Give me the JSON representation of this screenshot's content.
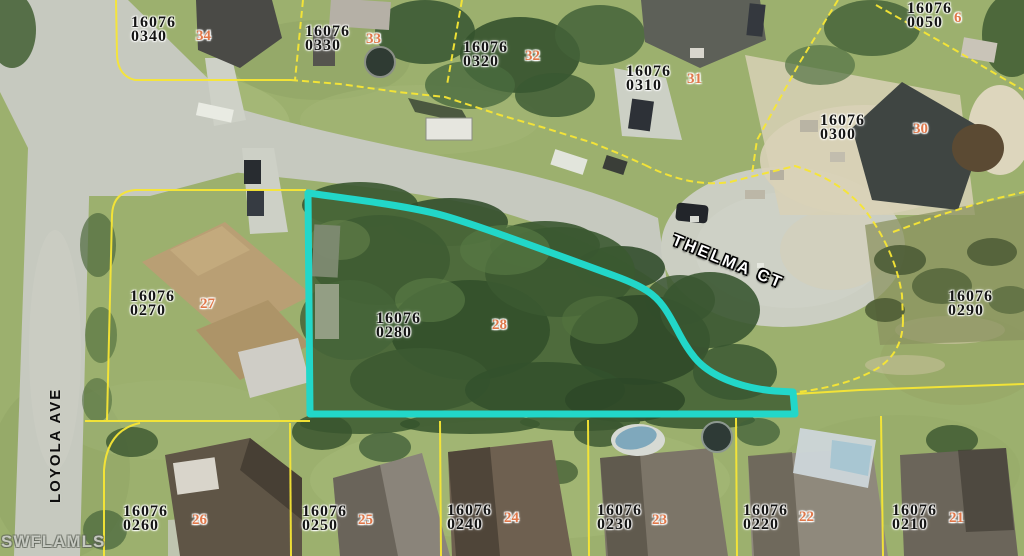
{
  "map": {
    "type": "aerial-parcel-map",
    "watermark": "SWFLAMLS",
    "streets": [
      {
        "name": "THELMA CT"
      },
      {
        "name": "LOYOLA AVE"
      }
    ],
    "colors": {
      "subject_outline": "#22d7c9",
      "parcel_line": "#f7e635",
      "parcel_text": "#141414",
      "lot_number_text": "#e0784a",
      "street_text_light": "#ffffff",
      "street_text_dark": "#0d0d0d"
    },
    "subject_parcel": {
      "id": "16076",
      "suffix": "0280",
      "lot": "28"
    },
    "parcels": [
      {
        "id": "16076",
        "suffix": "0340",
        "lot": "34",
        "x": 131,
        "y": 16,
        "lotX": 196,
        "lotY": 29
      },
      {
        "id": "16076",
        "suffix": "0330",
        "lot": "33",
        "x": 305,
        "y": 25,
        "lotX": 366,
        "lotY": 32
      },
      {
        "id": "16076",
        "suffix": "0320",
        "lot": "32",
        "x": 463,
        "y": 41,
        "lotX": 525,
        "lotY": 49
      },
      {
        "id": "16076",
        "suffix": "0310",
        "lot": "31",
        "x": 626,
        "y": 65,
        "lotX": 687,
        "lotY": 72
      },
      {
        "id": "16076",
        "suffix": "0300",
        "lot": "30",
        "x": 820,
        "y": 114,
        "lotX": 913,
        "lotY": 122
      },
      {
        "id": "16076",
        "suffix": "0050",
        "lot": "6",
        "x": 907,
        "y": 2,
        "lotX": 954,
        "lotY": 11
      },
      {
        "id": "16076",
        "suffix": "0270",
        "lot": "27",
        "x": 130,
        "y": 290,
        "lotX": 200,
        "lotY": 297
      },
      {
        "id": "16076",
        "suffix": "0280",
        "lot": "28",
        "x": 376,
        "y": 312,
        "lotX": 492,
        "lotY": 318,
        "highlighted": true
      },
      {
        "id": "16076",
        "suffix": "0290",
        "lot": "",
        "x": 948,
        "y": 290
      },
      {
        "id": "16076",
        "suffix": "0260",
        "lot": "26",
        "x": 123,
        "y": 505,
        "lotX": 192,
        "lotY": 513
      },
      {
        "id": "16076",
        "suffix": "0250",
        "lot": "25",
        "x": 302,
        "y": 505,
        "lotX": 358,
        "lotY": 513
      },
      {
        "id": "16076",
        "suffix": "0240",
        "lot": "24",
        "x": 447,
        "y": 504,
        "lotX": 504,
        "lotY": 511
      },
      {
        "id": "16076",
        "suffix": "0230",
        "lot": "23",
        "x": 597,
        "y": 504,
        "lotX": 652,
        "lotY": 513
      },
      {
        "id": "16076",
        "suffix": "0220",
        "lot": "22",
        "x": 743,
        "y": 504,
        "lotX": 799,
        "lotY": 510
      },
      {
        "id": "16076",
        "suffix": "0210",
        "lot": "21",
        "x": 892,
        "y": 504,
        "lotX": 949,
        "lotY": 511
      }
    ]
  }
}
